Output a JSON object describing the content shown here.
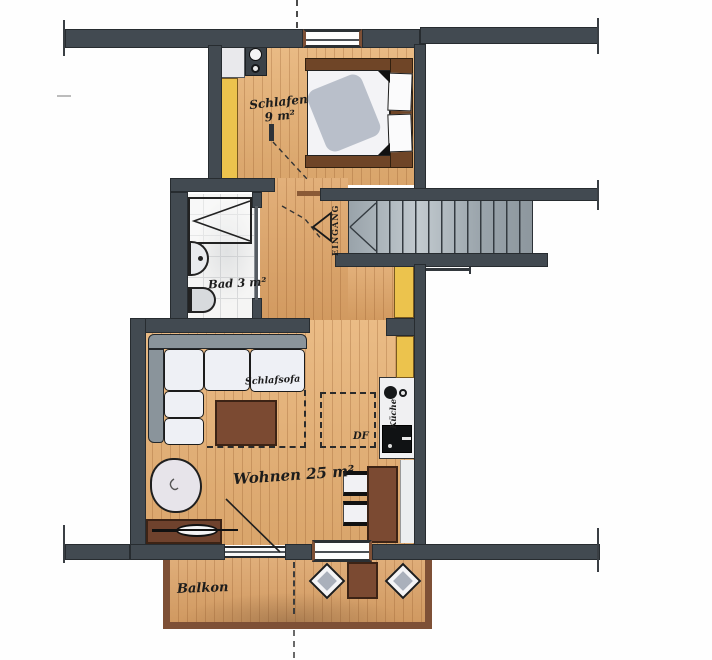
{
  "plan": {
    "rooms": {
      "schlafen": {
        "name": "Schlafen",
        "area": "9 m²"
      },
      "bad": {
        "name": "Bad",
        "area": "3 m²"
      },
      "wohnen": {
        "name": "Wohnen",
        "area": "25 m²"
      },
      "balkon": {
        "name": "Balkon"
      }
    },
    "labels": {
      "eingang": "EINGANG",
      "schlafsofa": "Schlafsofa",
      "kueche": "Küche",
      "df": "DF"
    },
    "colors": {
      "wall": "#424a51",
      "wood_floor": "#e6b078",
      "balcony_floor": "#dda66c",
      "wardrobe_yellow": "#ecc34d",
      "stairs_gray": "#a2abb1",
      "furniture_brown": "#7b4a32",
      "tile_white": "#f5f5f4"
    }
  }
}
